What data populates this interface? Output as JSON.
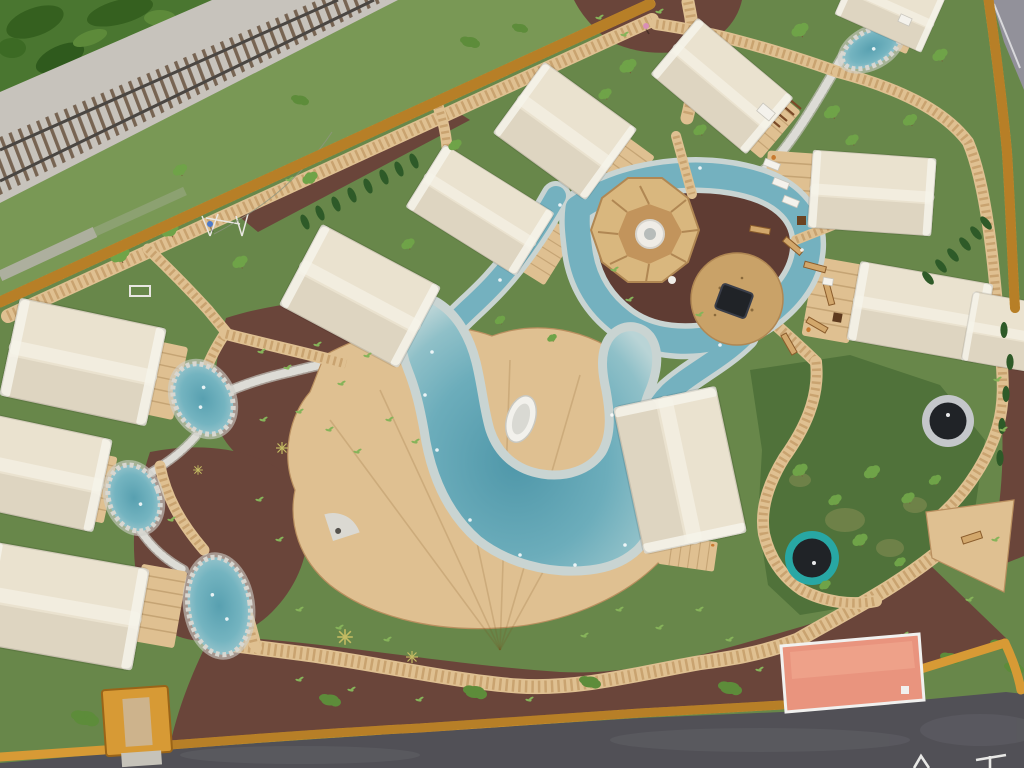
{
  "scene": {
    "title": "Aerial drone view of a glamping resort with safari tents, boardwalks and a lazy-river pool",
    "description": "Bird's-eye photo: a fenced glamping campsite with cream safari tents arranged around a winding turquoise bathing stream and pool, timber boardwalks, a central octagonal play tower on a mulch island, two in-ground trampolines, private plunge ponds by each tent, a railway line passing the top-left corner and an asphalt road along the bottom.",
    "environment": {
      "railway": "gravel railway line crossing the top-left corner diagonally",
      "access_path": "grey footpath between the railway and the fence",
      "fence": "orange timber perimeter fence",
      "road_bottom": "dark asphalt road along the bottom edge",
      "road_top_right": "grey road wedge beyond the fence in the top-right corner",
      "road_markings": "partially visible white painted letters on the asphalt"
    },
    "features": {
      "safari_tents_count": 12,
      "private_ponds_count": 4,
      "in_ground_trampolines_count": 2,
      "playground": "octagonal timber play tower with white slide core, sand circle, navy ground trampoline and log benches on a mulch island",
      "lazy_river": "concrete-edged turquoise stream looping around the play island into a large free-form pool",
      "pool_boat": "white rowing boat parked on the deck peninsula",
      "boardwalks": "network of light timber boardwalks and decks connecting all tents",
      "gate": "orange timber entrance gate in the bottom fence",
      "building_salmon_roof": "salmon-pink flat-roofed service building on the bottom fence line",
      "people_count": 2,
      "stone_creeks": "white pebble creek beds linking the plunge ponds"
    },
    "colors": {
      "grass": "#68874a",
      "grassWarm": "#7b9a57",
      "grassDark": "#4e7038",
      "wild": "#4a7630",
      "ballast": "#c7c3bc",
      "tie": "#6e5946",
      "rail": "#4a4642",
      "pathGray": "#b3b1a6",
      "fence": "#d79a35",
      "road": "#515056",
      "roadUpper": "#92919a",
      "mulch": "#6a453a",
      "deck": "#dfc091",
      "waterRim": "#c9d4d2",
      "water": "#74b1bf",
      "poolDeep": "#4f97a9",
      "stone": "#d8d7d1",
      "tent": "#eae2cf",
      "hedge": "#2e5a28",
      "tree": "#6fa348",
      "sand": "#c9a268",
      "octagon": "#d9b77e",
      "trampolineGrayRim": "#c4c7ca",
      "trampolineTealRim": "#28a7a4",
      "trampolineMat": "#202327",
      "salmon": "#e9947e",
      "boat": "#f2f1ec",
      "person1": "#d98fb5",
      "person2": "#4d79c8"
    }
  }
}
